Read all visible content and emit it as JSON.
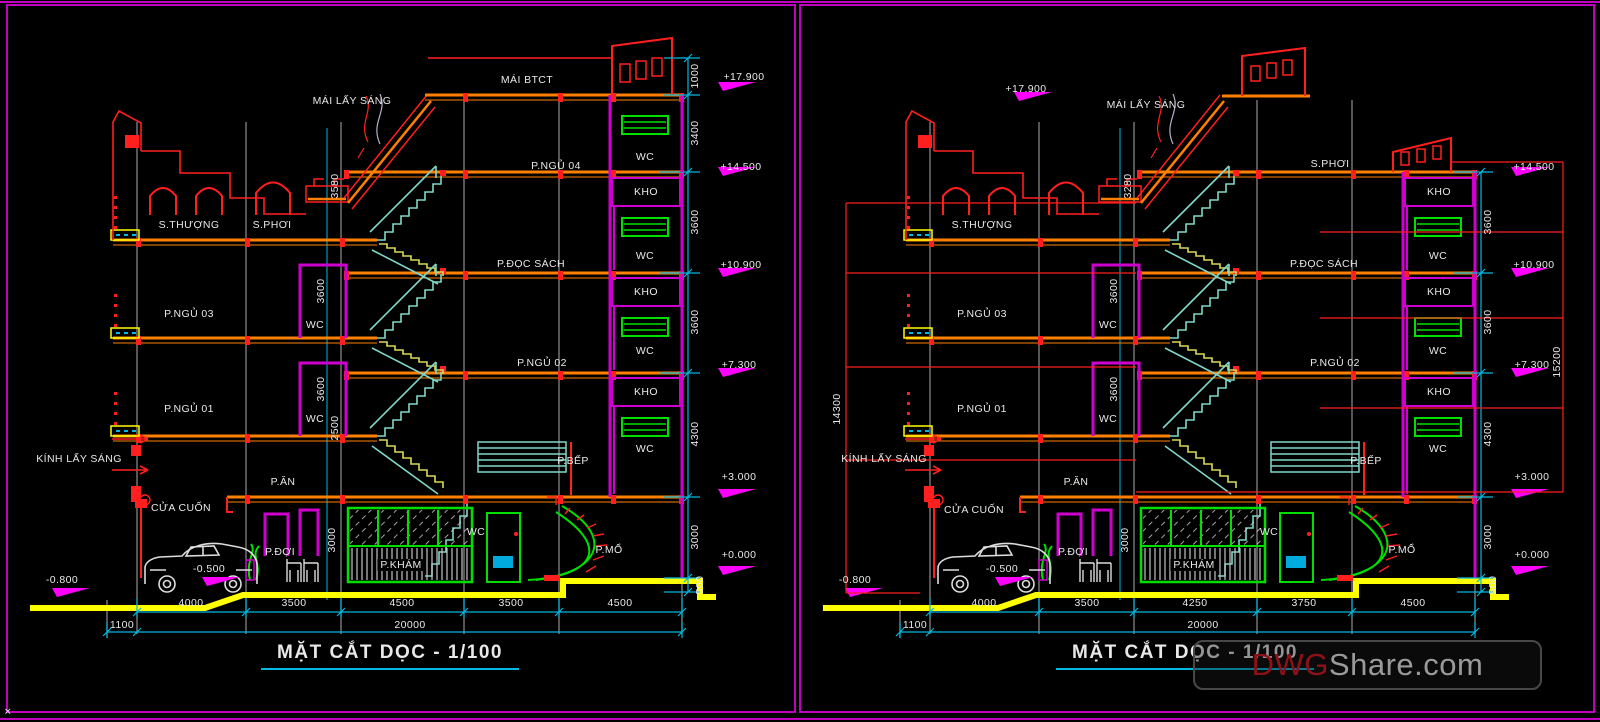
{
  "colors": {
    "orange": "#ff7f00",
    "red": "#ff1f1f",
    "mag": "#cf00cf",
    "bmag": "#ff00ff",
    "teal": "#7fd8c8",
    "yz": "#d8d855",
    "cy": "#00b8e0",
    "gray": "#8f8f8f",
    "grn": "#00e000",
    "yel": "#ffff00",
    "txt": "#e8e8e8",
    "bor": "#bf00bf",
    "wmred": "#8d1118",
    "wmgray": "#9a9a9a"
  },
  "watermark": {
    "prefix": "DWG",
    "suffix": "Share.com"
  },
  "panels": [
    {
      "title": "MẶT CẮT DỌC - 1/100",
      "labels": [
        {
          "t": "MÁI BTCT",
          "x": 527,
          "y": 80
        },
        {
          "t": "MÁI LẤY SÁNG",
          "x": 352,
          "y": 101
        },
        {
          "t": "+17.900",
          "x": 744,
          "y": 77
        },
        {
          "t": "1000",
          "x": 695,
          "y": 76,
          "r": 1
        },
        {
          "t": "3400",
          "x": 695,
          "y": 133,
          "r": 1
        },
        {
          "t": "P.NGỦ 04",
          "x": 556,
          "y": 166
        },
        {
          "t": "WC",
          "x": 645,
          "y": 157
        },
        {
          "t": "+14.500",
          "x": 741,
          "y": 167
        },
        {
          "t": "KHO",
          "x": 646,
          "y": 192
        },
        {
          "t": "3600",
          "x": 695,
          "y": 222,
          "r": 1
        },
        {
          "t": "S.THƯỢNG",
          "x": 189,
          "y": 225
        },
        {
          "t": "S.PHƠI",
          "x": 272,
          "y": 225
        },
        {
          "t": "3580",
          "x": 335,
          "y": 186,
          "r": 1
        },
        {
          "t": "WC",
          "x": 645,
          "y": 256
        },
        {
          "t": "P.ĐỌC SÁCH",
          "x": 531,
          "y": 264
        },
        {
          "t": "+10.900",
          "x": 741,
          "y": 265
        },
        {
          "t": "KHO",
          "x": 646,
          "y": 292
        },
        {
          "t": "3600",
          "x": 321,
          "y": 291,
          "r": 1
        },
        {
          "t": "WC",
          "x": 315,
          "y": 325
        },
        {
          "t": "P.NGỦ 03",
          "x": 189,
          "y": 314
        },
        {
          "t": "3600",
          "x": 695,
          "y": 322,
          "r": 1
        },
        {
          "t": "WC",
          "x": 645,
          "y": 351
        },
        {
          "t": "P.NGỦ 02",
          "x": 542,
          "y": 363
        },
        {
          "t": "+7.300",
          "x": 739,
          "y": 365
        },
        {
          "t": "KHO",
          "x": 646,
          "y": 392
        },
        {
          "t": "P.NGỦ 01",
          "x": 189,
          "y": 409
        },
        {
          "t": "3600",
          "x": 321,
          "y": 389,
          "r": 1
        },
        {
          "t": "WC",
          "x": 315,
          "y": 419
        },
        {
          "t": "2500",
          "x": 335,
          "y": 428,
          "r": 1
        },
        {
          "t": "4300",
          "x": 695,
          "y": 434,
          "r": 1
        },
        {
          "t": "WC",
          "x": 645,
          "y": 449
        },
        {
          "t": "KÍNH LẤY SÁNG",
          "x": 79,
          "y": 459
        },
        {
          "t": "P.ĂN",
          "x": 283,
          "y": 482
        },
        {
          "t": "P.BẾP",
          "x": 573,
          "y": 461
        },
        {
          "t": "+3.000",
          "x": 739,
          "y": 477
        },
        {
          "t": "CỬA CUỐN",
          "x": 181,
          "y": 508
        },
        {
          "t": "P.ĐỢI",
          "x": 280,
          "y": 552
        },
        {
          "t": "3000",
          "x": 332,
          "y": 540,
          "r": 1
        },
        {
          "t": "P.KHÁM",
          "x": 401,
          "y": 565,
          "b": 1
        },
        {
          "t": "WC",
          "x": 476,
          "y": 532
        },
        {
          "t": "P.MỔ",
          "x": 609,
          "y": 550
        },
        {
          "t": "3000",
          "x": 695,
          "y": 537,
          "r": 1
        },
        {
          "t": "+0.000",
          "x": 739,
          "y": 555
        },
        {
          "t": "500",
          "x": 700,
          "y": 585,
          "r": 1
        },
        {
          "t": "-0.500",
          "x": 209,
          "y": 569
        },
        {
          "t": "-0.800",
          "x": 62,
          "y": 580
        },
        {
          "t": "4000",
          "x": 191,
          "y": 603
        },
        {
          "t": "3500",
          "x": 294,
          "y": 603
        },
        {
          "t": "4500",
          "x": 402,
          "y": 603
        },
        {
          "t": "3500",
          "x": 511,
          "y": 603
        },
        {
          "t": "4500",
          "x": 620,
          "y": 603
        },
        {
          "t": "1100",
          "x": 122,
          "y": 625
        },
        {
          "t": "20000",
          "x": 410,
          "y": 625
        },
        {
          "t": "✕",
          "x": 8,
          "y": 712,
          "s": 9
        }
      ]
    },
    {
      "title": "MẶT CẮT DỌC - 1/100",
      "labels": [
        {
          "t": "MÁI LẤY SÁNG",
          "x": 1146,
          "y": 105
        },
        {
          "t": "+17.900",
          "x": 1026,
          "y": 89
        },
        {
          "t": "S.PHƠI",
          "x": 1330,
          "y": 164
        },
        {
          "t": "+14.500",
          "x": 1534,
          "y": 167
        },
        {
          "t": "3280",
          "x": 1128,
          "y": 186,
          "r": 1
        },
        {
          "t": "S.THƯỢNG",
          "x": 982,
          "y": 225
        },
        {
          "t": "KHO",
          "x": 1439,
          "y": 192
        },
        {
          "t": "3600",
          "x": 1488,
          "y": 222,
          "r": 1
        },
        {
          "t": "WC",
          "x": 1438,
          "y": 256
        },
        {
          "t": "P.ĐỌC SÁCH",
          "x": 1324,
          "y": 264
        },
        {
          "t": "+10.900",
          "x": 1534,
          "y": 265
        },
        {
          "t": "KHO",
          "x": 1439,
          "y": 292
        },
        {
          "t": "3600",
          "x": 1114,
          "y": 291,
          "r": 1
        },
        {
          "t": "WC",
          "x": 1108,
          "y": 325
        },
        {
          "t": "P.NGỦ 03",
          "x": 982,
          "y": 314
        },
        {
          "t": "3600",
          "x": 1488,
          "y": 322,
          "r": 1
        },
        {
          "t": "14300",
          "x": 837,
          "y": 409,
          "r": 1
        },
        {
          "t": "WC",
          "x": 1438,
          "y": 351
        },
        {
          "t": "P.NGỦ 02",
          "x": 1335,
          "y": 363
        },
        {
          "t": "+7.300",
          "x": 1532,
          "y": 365
        },
        {
          "t": "15200",
          "x": 1557,
          "y": 362,
          "r": 1
        },
        {
          "t": "KHO",
          "x": 1439,
          "y": 392
        },
        {
          "t": "P.NGỦ 01",
          "x": 982,
          "y": 409
        },
        {
          "t": "3600",
          "x": 1114,
          "y": 389,
          "r": 1
        },
        {
          "t": "WC",
          "x": 1108,
          "y": 419
        },
        {
          "t": "4300",
          "x": 1488,
          "y": 434,
          "r": 1
        },
        {
          "t": "WC",
          "x": 1438,
          "y": 449
        },
        {
          "t": "KÍNH LẤY SÁNG",
          "x": 884,
          "y": 459
        },
        {
          "t": "P.ĂN",
          "x": 1076,
          "y": 482
        },
        {
          "t": "P.BẾP",
          "x": 1366,
          "y": 461
        },
        {
          "t": "+3.000",
          "x": 1532,
          "y": 477
        },
        {
          "t": "CỬA CUỐN",
          "x": 974,
          "y": 510
        },
        {
          "t": "P.ĐỢI",
          "x": 1073,
          "y": 552
        },
        {
          "t": "3000",
          "x": 1125,
          "y": 540,
          "r": 1
        },
        {
          "t": "P.KHÁM",
          "x": 1194,
          "y": 565,
          "b": 1
        },
        {
          "t": "WC",
          "x": 1269,
          "y": 532
        },
        {
          "t": "P.MỔ",
          "x": 1402,
          "y": 550
        },
        {
          "t": "3000",
          "x": 1488,
          "y": 537,
          "r": 1
        },
        {
          "t": "+0.000",
          "x": 1532,
          "y": 555
        },
        {
          "t": "500",
          "x": 1493,
          "y": 585,
          "r": 1
        },
        {
          "t": "-0.500",
          "x": 1002,
          "y": 569
        },
        {
          "t": "-0.800",
          "x": 855,
          "y": 580
        },
        {
          "t": "4000",
          "x": 984,
          "y": 603
        },
        {
          "t": "3500",
          "x": 1087,
          "y": 603
        },
        {
          "t": "4250",
          "x": 1195,
          "y": 603
        },
        {
          "t": "3750",
          "x": 1304,
          "y": 603
        },
        {
          "t": "4500",
          "x": 1413,
          "y": 603
        },
        {
          "t": "1100",
          "x": 915,
          "y": 625
        },
        {
          "t": "20000",
          "x": 1203,
          "y": 625
        }
      ]
    }
  ]
}
